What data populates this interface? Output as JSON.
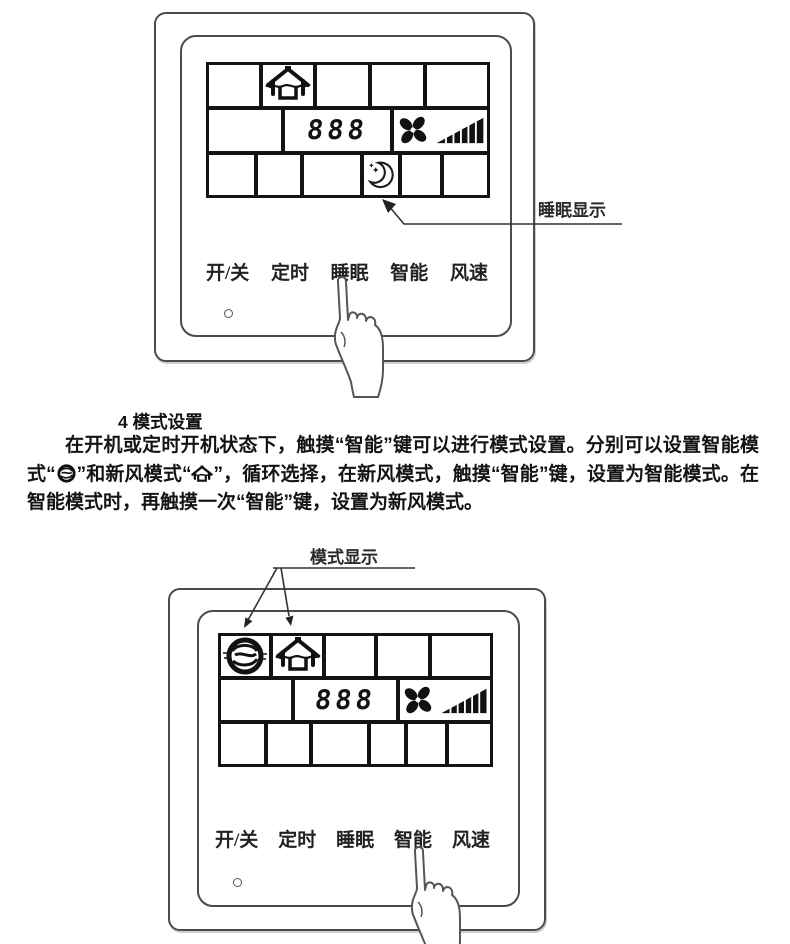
{
  "colors": {
    "background": "#ffffff",
    "panel_line": "#4b4b4b",
    "lcd_border": "#131313",
    "text": "#1d1d1d"
  },
  "figure_sleep": {
    "callout": "睡眠显示",
    "display": {
      "digits": "888"
    },
    "buttons": [
      "开/关",
      "定时",
      "睡眠",
      "智能",
      "风速"
    ],
    "touch_target": "睡眠"
  },
  "section4": {
    "heading": "4 模式设置",
    "p_run1": "在开机或定时开机状态下，触摸“智能”键可以进行模式设置。分别可以设置智能模式",
    "p_quote_open": "“",
    "p_mid": "”和新风模式“",
    "p_tail": "”，循环选择，在新风模式，触摸“智能”键，设置为智能模式。在智能模式时，再触摸一次“智能”键，设置为新风模式。"
  },
  "figure_mode": {
    "callout": "模式显示",
    "display": {
      "digits": "888"
    },
    "buttons": [
      "开/关",
      "定时",
      "睡眠",
      "智能",
      "风速"
    ],
    "touch_target": "智能"
  },
  "icons": {
    "fresh_air": "house-with-airflow",
    "smart_mode": "swirl-sphere",
    "sleep": "moon-with-stars",
    "fan": "pinwheel-fan",
    "fan_speed": "speed-ramp-bars",
    "power_led": "small-circle-indicator",
    "touch": "pointing-hand"
  }
}
